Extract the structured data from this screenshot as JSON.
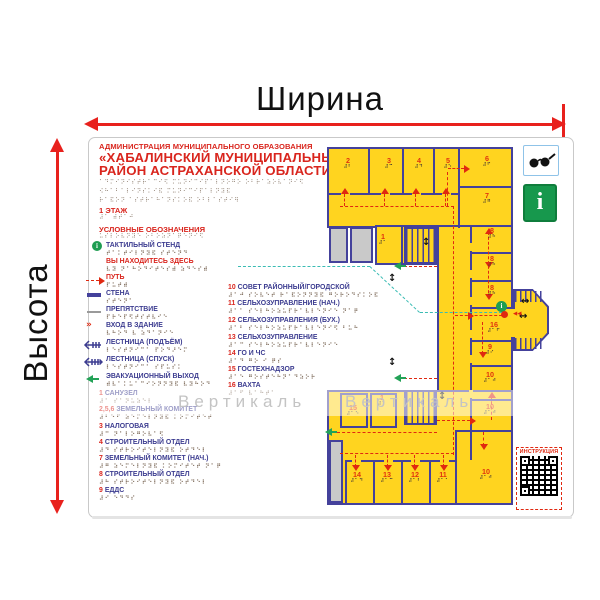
{
  "dimensions": {
    "width_label": "Ширина",
    "height_label": "Высота"
  },
  "panel": {
    "org_line": "АДМИНИСТРАЦИЯ МУНИЦИПАЛЬНОГО ОБРАЗОВАНИЯ",
    "title_line1": "«ХАБАЛИНСКИЙ МУНИЦИПАЛЬНЫЙ",
    "title_line2": "РАЙОН АСТРАХАНСКОЙ ОБЛАСТИ»",
    "title_braille1": "⠁⠙⠍⠊⠝⠊⠎⠞⠗⠁⠉⠊⠫ ⠍⠥⠝⠊⠉⠊⠏⠁⠇⠝⠕⠛⠕ ⠕⠃⠗⠁⠵⠕⠧⠁⠝⠊⠫",
    "title_braille2": "⠪⠓⠁⠃⠁⠇⠊⠝⠎⠅⠊⠯ ⠍⠥⠝⠊⠉⠊⠏⠁⠇⠝⠽⠯",
    "title_braille3": "⠗⠁⠯⠕⠝ ⠁⠎⠞⠗⠁⠓⠁⠝⠎⠅⠕⠯ ⠕⠃⠇⠁⠎⠞⠊⠻",
    "floor_label": "1 ЭТАЖ",
    "floor_braille": "⠼⠁ ⠾⠞⠁⠚",
    "legend_title": "УСЛОВНЫЕ ОБОЗНАЧЕНИЯ",
    "legend_title_braille": "⠥⠎⠇⠕⠧⠝⠽⠑ ⠕⠃⠕⠵⠝⠁⠟⠑⠝⠊⠫"
  },
  "legend": {
    "items": [
      {
        "icon": "info-circle-icon",
        "label": "ТАКТИЛЬНЫЙ СТЕНД",
        "braille": "⠞⠁⠅⠞⠊⠇⠝⠽⠯ ⠎⠞⠑⠝⠙"
      },
      {
        "icon": "",
        "label": "ВЫ НАХОДИТЕСЬ ЗДЕСЬ",
        "braille": "⠧⠽ ⠝⠁⠓⠕⠙⠊⠞⠑⠎⠾ ⠵⠙⠑⠎⠾"
      },
      {
        "icon": "path-dashed-arrow-icon",
        "label": "ПУТЬ",
        "braille": "⠏⠥⠞⠾"
      },
      {
        "icon": "wall-line-icon",
        "label": "СТЕНА",
        "braille": "⠎⠞⠑⠝⠁"
      },
      {
        "icon": "obstacle-line-icon",
        "label": "ПРЕПЯТСТВИЕ",
        "braille": "⠏⠗⠑⠏⠫⠞⠎⠞⠧⠊⠑"
      },
      {
        "icon": "entrance-arrows-icon",
        "label": "ВХОД В ЗДАНИЕ",
        "braille": "⠧⠓⠕⠙ ⠧ ⠵⠙⠁⠝⠊⠑"
      },
      {
        "icon": "stairs-up-icon",
        "label": "ЛЕСТНИЦА (ПОДЪЁМ)",
        "braille": "⠇⠑⠎⠞⠝⠊⠉⠁ ⠏⠕⠙⠜⠑⠍"
      },
      {
        "icon": "stairs-down-icon",
        "label": "ЛЕСТНИЦА (СПУСК)",
        "braille": "⠇⠑⠎⠞⠝⠊⠉⠁ ⠎⠏⠥⠎⠅"
      },
      {
        "icon": "exit-arrow-icon",
        "label": "ЭВАКУАЦИОННЫЙ ВЫХОД",
        "braille": "⠾⠧⠁⠅⠥⠁⠉⠊⠕⠝⠝⠽⠯ ⠧⠽⠓⠕⠙"
      }
    ]
  },
  "room_list_left": [
    {
      "num": "1",
      "name": "САНУЗЕЛ",
      "braille": "⠼⠁ ⠎⠁⠝⠥⠵⠑⠇"
    },
    {
      "num": "2,5,6",
      "name": "ЗЕМЕЛЬНЫЙ КОМИТЕТ",
      "braille": "⠼⠃⠑⠋ ⠵⠑⠍⠑⠇⠝⠽⠯ ⠅⠕⠍⠊⠞⠑⠞"
    },
    {
      "num": "3",
      "name": "НАЛОГОВАЯ",
      "braille": "⠼⠉ ⠝⠁⠇⠕⠛⠕⠧⠁⠫"
    },
    {
      "num": "4",
      "name": "СТРОИТЕЛЬНЫЙ ОТДЕЛ",
      "braille": "⠼⠙ ⠎⠞⠗⠕⠊⠞⠑⠇⠝⠽⠯ ⠕⠞⠙⠑⠇"
    },
    {
      "num": "7",
      "name": "ЗЕМЕЛЬНЫЙ КОМИТЕТ (НАЧ.)",
      "braille": "⠼⠛ ⠵⠑⠍⠑⠇⠝⠽⠯ ⠅⠕⠍⠊⠞⠑⠞ ⠝⠁⠟"
    },
    {
      "num": "8",
      "name": "СТРОИТЕЛЬНЫЙ ОТДЕЛ",
      "braille": "⠼⠓ ⠎⠞⠗⠕⠊⠞⠑⠇⠝⠽⠯ ⠕⠞⠙⠑⠇"
    },
    {
      "num": "9",
      "name": "ЕДДС",
      "braille": "⠼⠊ ⠑⠙⠙⠎"
    }
  ],
  "room_list_middle": [
    {
      "num": "10",
      "name": "СОВЕТ РАЙОННЫЙ/ГОРОДСКОЙ",
      "braille": "⠼⠁⠚ ⠎⠕⠧⠑⠞ ⠗⠁⠯⠕⠝⠝⠽⠯ ⠛⠕⠗⠕⠙⠎⠅⠕⠯"
    },
    {
      "num": "11",
      "name": "СЕЛЬХОЗУПРАВЛЕНИЕ (НАЧ.)",
      "braille": "⠼⠁⠁ ⠎⠑⠇⠓⠕⠵⠥⠏⠗⠁⠧⠇⠑⠝⠊⠑ ⠝⠁⠟"
    },
    {
      "num": "12",
      "name": "СЕЛЬХОЗУПРАВЛЕНИЯ (БУХ.)",
      "braille": "⠼⠁⠃ ⠎⠑⠇⠓⠕⠵⠥⠏⠗⠁⠧⠇⠑⠝⠊⠫ ⠃⠥⠓"
    },
    {
      "num": "13",
      "name": "СЕЛЬХОЗУПРАВЛЕНИЕ",
      "braille": "⠼⠁⠉ ⠎⠑⠇⠓⠕⠵⠥⠏⠗⠁⠧⠇⠑⠝⠊⠑"
    },
    {
      "num": "14",
      "name": "ГО И ЧС",
      "braille": "⠼⠁⠙ ⠛⠕ ⠊ ⠟⠎"
    },
    {
      "num": "15",
      "name": "ГОСТЕХНАДЗОР",
      "braille": "⠼⠁⠑ ⠛⠕⠎⠞⠑⠓⠝⠁⠙⠵⠕⠗"
    },
    {
      "num": "16",
      "name": "ВАХТА",
      "braille": "⠼⠁⠋ ⠧⠁⠓⠞⠁"
    }
  ],
  "plan": {
    "watermark": "Вертикаль",
    "rooms": [
      {
        "num": "2",
        "braille": "⠼⠃"
      },
      {
        "num": "3",
        "braille": "⠼⠉"
      },
      {
        "num": "4",
        "braille": "⠼⠙"
      },
      {
        "num": "5",
        "braille": "⠼⠑"
      },
      {
        "num": "6",
        "braille": "⠼⠋"
      },
      {
        "num": "7",
        "braille": "⠼⠛"
      },
      {
        "num": "8",
        "braille": "⠼⠓"
      },
      {
        "num": "8",
        "braille": "⠼⠓"
      },
      {
        "num": "8",
        "braille": "⠼⠓"
      },
      {
        "num": "16",
        "braille": "⠼⠁⠋"
      },
      {
        "num": "9",
        "braille": "⠼⠊"
      },
      {
        "num": "10",
        "braille": "⠼⠁⠚"
      },
      {
        "num": "10",
        "braille": "⠼⠁⠚"
      },
      {
        "num": "10",
        "braille": "⠼⠁⠚"
      },
      {
        "num": "11",
        "braille": "⠼⠁⠁"
      },
      {
        "num": "12",
        "braille": "⠼⠁⠃"
      },
      {
        "num": "13",
        "braille": "⠼⠁⠉"
      },
      {
        "num": "14",
        "braille": "⠼⠁⠙"
      },
      {
        "num": "15",
        "braille": "⠼⠁⠑"
      },
      {
        "num": "1",
        "braille": "⠼⠁"
      },
      {
        "num": "1",
        "braille": "⠼⠁"
      }
    ]
  },
  "badges": {
    "qr_label": "ИНСТРУКЦИЯ",
    "info_sign_glyph": "i"
  },
  "colors": {
    "accent_red": "#d9251d",
    "plan_red": "#e02810",
    "wall_navy": "#44419b",
    "room_yellow": "#ffd41f",
    "exit_green": "#23a257",
    "you_are_here_teal": "#3bbcb4",
    "info_green": "#1f9d52"
  }
}
